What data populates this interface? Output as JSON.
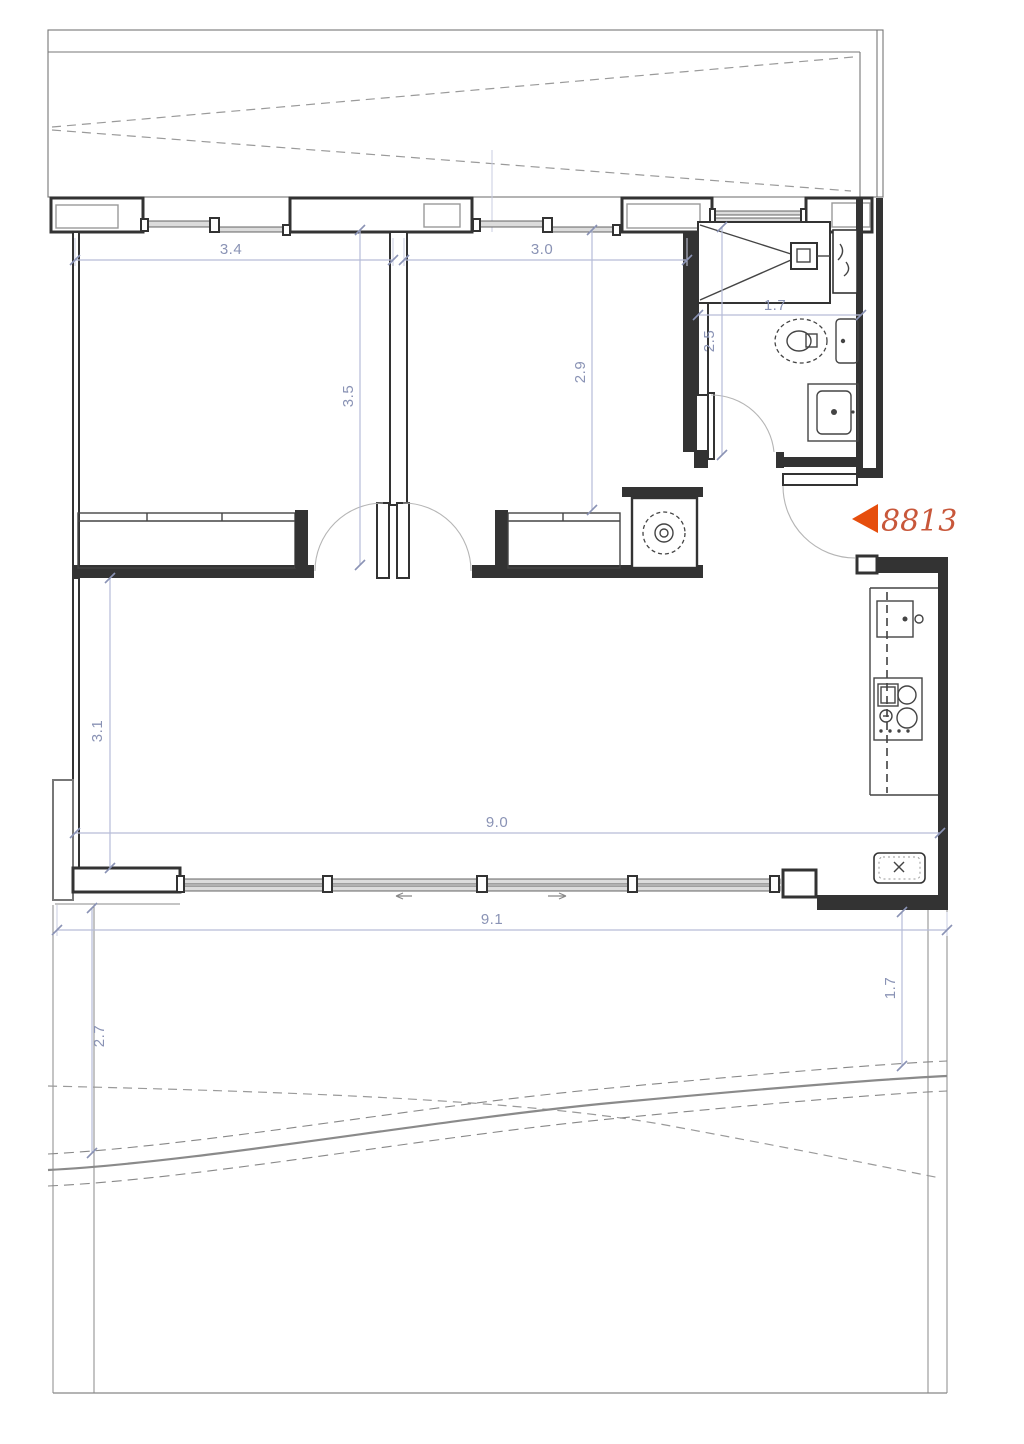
{
  "floor_plan": {
    "marker": {
      "label": "8813"
    },
    "dimensions": {
      "bedroom1_width": "3.4",
      "bedroom1_depth": "3.5",
      "bedroom2_width": "3.0",
      "bedroom2_depth": "2.9",
      "bathroom_width": "1.7",
      "bathroom_depth": "2.5",
      "living_depth": "3.1",
      "living_width": "9.0",
      "plot_width": "9.1",
      "terrace_depth_left": "2.7",
      "terrace_depth_right": "1.7"
    },
    "colors": {
      "wall": "#333333",
      "dimension_line": "#b6bcd8",
      "dimension_text": "#8a93b5",
      "marker_triangle": "#e64e0d",
      "marker_text": "#c8573a",
      "outline": "#777777"
    }
  }
}
